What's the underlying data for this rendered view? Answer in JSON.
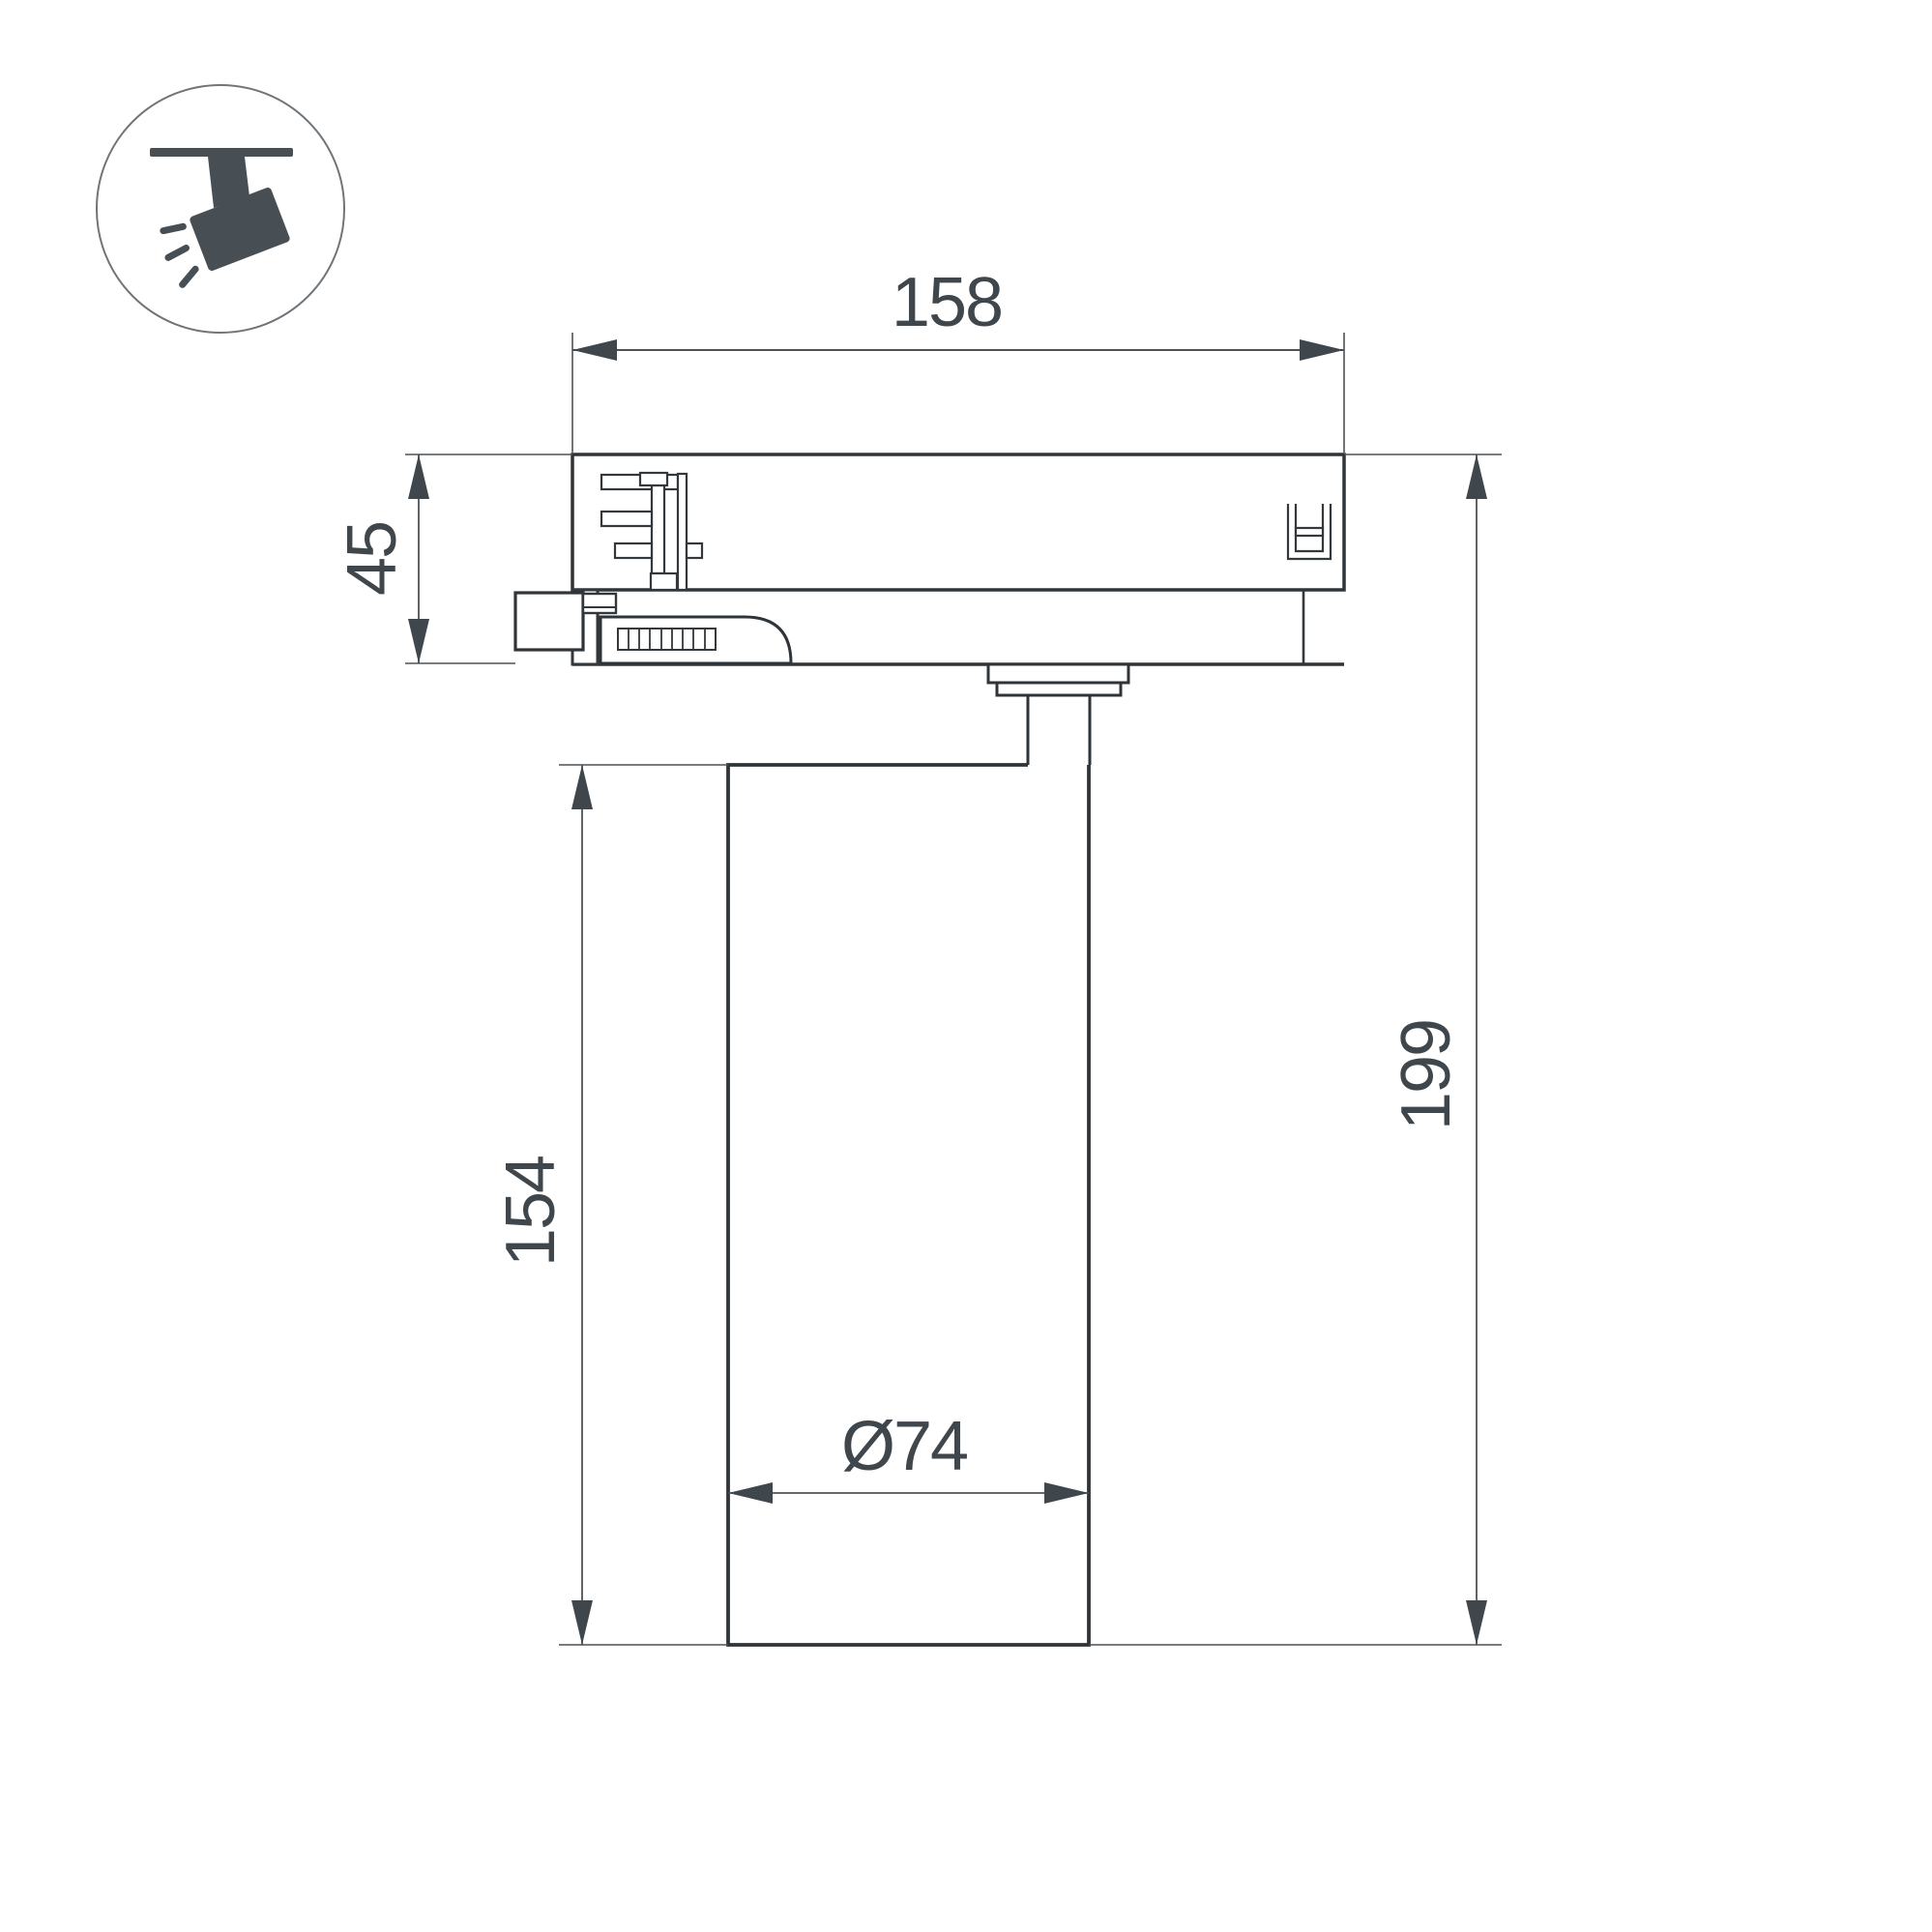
{
  "drawing": {
    "background": "#ffffff",
    "outline_color": "#2f3438",
    "thin_line_color": "#4d5257",
    "label_color": "#3f464c",
    "icon_color": "#474f55",
    "icon_circle_stroke": "#70757a"
  },
  "icon": {
    "name": "track-spotlight-icon",
    "meaning": "ceiling track mounted spotlight"
  },
  "dimensions": {
    "track_adapter_width": "158",
    "track_adapter_height": "45",
    "lamp_body_height": "154",
    "total_height": "199",
    "lamp_body_diameter": "Ø74"
  }
}
